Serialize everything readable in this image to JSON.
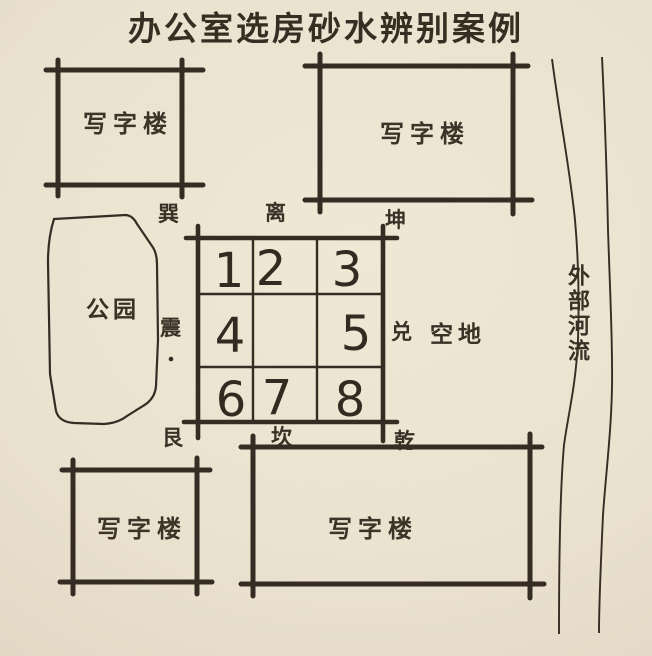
{
  "title": "办公室选房砂水辨别案例",
  "buildings": {
    "top_left": "写字楼",
    "top_right": "写字楼",
    "bottom_left": "写字楼",
    "bottom_wide": "写字楼"
  },
  "park_label": "公园",
  "vacant_label": "空地",
  "river_label": "外部河流",
  "compass": {
    "xun": "巽",
    "li": "离",
    "kun": "坤",
    "zhen": "震",
    "dui": "兑",
    "gen": "艮",
    "kan": "坎",
    "qian": "乾"
  },
  "grid": {
    "cells": [
      "1",
      "2",
      "3",
      "4",
      "",
      "5",
      "6",
      "7",
      "8"
    ]
  },
  "colors": {
    "paper": "#ebe1cf",
    "ink": "#352c23"
  }
}
